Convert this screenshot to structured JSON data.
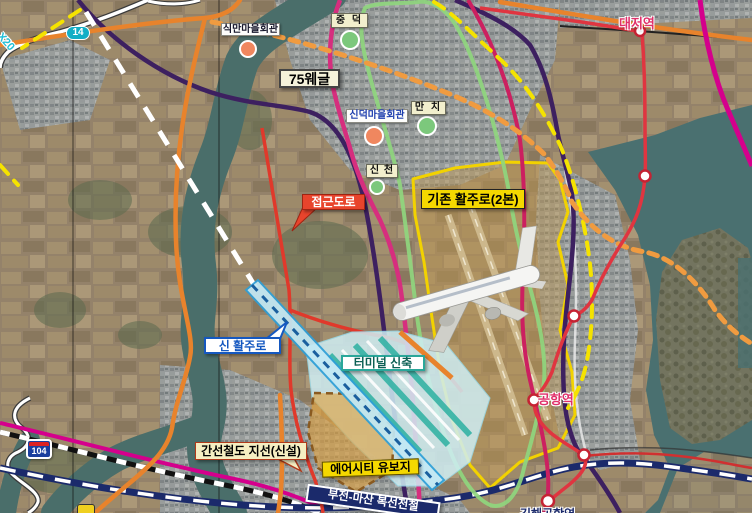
{
  "labels": {
    "sikman_hall": "식만마을회관",
    "jungdeok": "중 덕",
    "route75": "75웨글",
    "sindeok_hall": "신덕마을회관",
    "manchi": "만 치",
    "sincheon": "신 천",
    "existing_runway": "기존 활주로(2본)",
    "access_road": "접근도로",
    "new_runway": "신 활주로",
    "terminal_new": "터미널 신축",
    "trunk_rail_branch": "간선철도 지선(신설)",
    "aircity_reserve": "에어시티 유보지",
    "bujeon_masan_rail": "부전-마산 복선전철",
    "daejeo_station": "대저역",
    "gonghang_station": "공항역",
    "gimhae_airport_station": "김해공항역",
    "route_14": "14",
    "route_104": "104",
    "route_20": "X20"
  },
  "colors": {
    "runway_zone_yellow": "#F5D800",
    "access_red": "#E8442C",
    "new_runway_blue": "#2D9FD8",
    "new_runway_fill": "#C2E9F5",
    "terminal_teal": "#2AA79A",
    "aircity_orange": "#D99A3C",
    "rail_navy": "#1B2A6B",
    "lightrail_red": "#E03540",
    "station_pink": "#E0306A",
    "road_orange": "#E8832C",
    "route14_cyan": "#12AEC6",
    "green_loop": "#8FD67E",
    "magenta_line": "#D62E7E",
    "purple_line": "#3D2060",
    "yellow_dashed": "#F5E300",
    "orange_dashed": "#F09B40",
    "water": "#4A7070"
  }
}
